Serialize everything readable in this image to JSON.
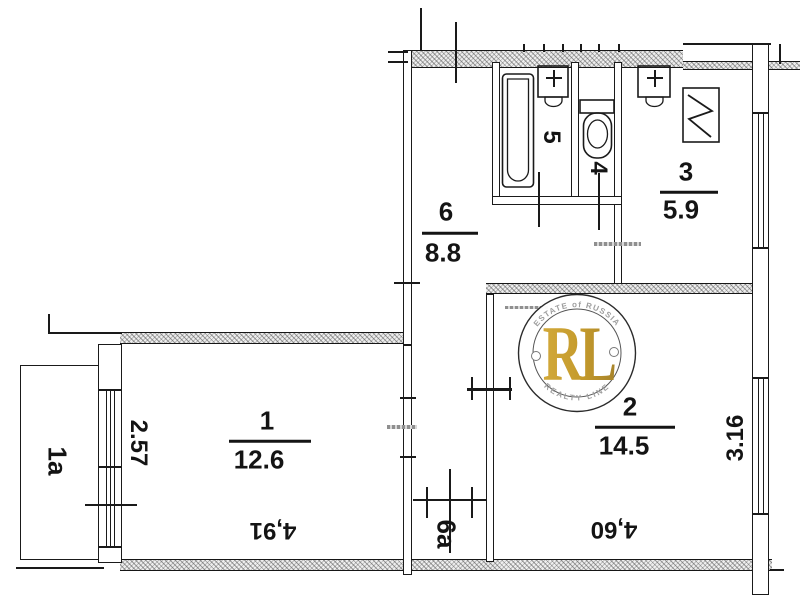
{
  "plan_title": "apartment-floor-plan",
  "rooms": {
    "r1": {
      "number": "1",
      "area": "12.6"
    },
    "r2": {
      "number": "2",
      "area": "14.5"
    },
    "r3": {
      "number": "3",
      "area": "5.9"
    },
    "r6": {
      "number": "6",
      "area": "8.8"
    },
    "r5": {
      "label": "5"
    },
    "r4": {
      "label": "4"
    },
    "r1a": {
      "label": "1a"
    },
    "r6a": {
      "label": "6a"
    }
  },
  "dimensions": {
    "room1_width": "2.57",
    "room1_length": "4,91",
    "room2_length": "4,60",
    "room2_width": "3.16"
  },
  "watermark": {
    "top_text": "ESTATE of RUSSIA",
    "initials": "RL",
    "bottom_text": "REALTY LINE",
    "gold_color": "#C49A2C",
    "ring_text_color": "#9e9e9e"
  },
  "colors": {
    "ink": "#1a1a1a",
    "door_mark": "#8f8f8f",
    "paper": "#ffffff"
  }
}
